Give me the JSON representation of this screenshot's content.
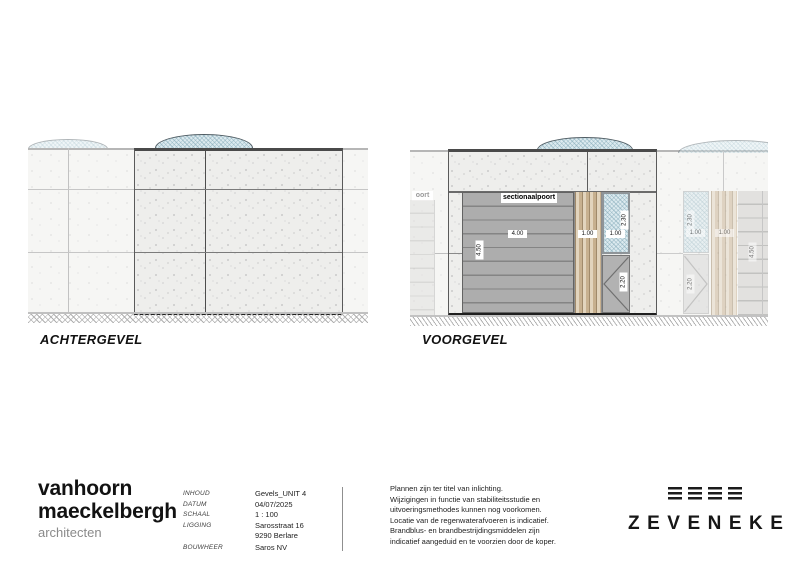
{
  "colors": {
    "window_blue": "#dceaef",
    "wood_tan": "#d4c1a4",
    "gate_gray": "#a5a5a5",
    "ink": "#121212"
  },
  "icons": {
    "door_swing": "chevron-lines",
    "logo_mark": "four-triple-bars"
  },
  "drawings": {
    "achtergevel": {
      "title": "ACHTERGEVEL"
    },
    "voorgevel": {
      "title": "VOORGEVEL",
      "gate_label": "sectionaalpoort",
      "gate_label_partial": "oort",
      "dims": {
        "gate_width": "4.00",
        "gate_height": "4.50",
        "slats_width": "1.00",
        "window_width": "1.00",
        "window_height": "2.30",
        "door_height": "2.20"
      },
      "adjacent_dims": {
        "window_height": "2.30",
        "window_width": "1.00",
        "slats_width": "1.00",
        "door_height": "2.20",
        "gate_height": "4.50"
      }
    }
  },
  "titleblock": {
    "firm": {
      "line1": "vanhoorn",
      "line2": "maeckelbergh",
      "subtitle": "architecten"
    },
    "fields": [
      {
        "label": "INHOUD",
        "value": "Gevels_UNIT 4"
      },
      {
        "label": "DATUM",
        "value": "04/07/2025"
      },
      {
        "label": "SCHAAL",
        "value": "1 : 100"
      },
      {
        "label": "LIGGING",
        "value": "Sarosstraat 16"
      },
      {
        "label": "",
        "value": "9290 Berlare"
      },
      {
        "label": "BOUWHEER",
        "value": "Saros NV"
      }
    ],
    "disclaimer": [
      "Plannen zijn ter titel van inlichting.",
      "Wijzigingen in functie van stabiliteitsstudie en",
      "uitvoeringsmethodes kunnen nog voorkomen.",
      "Locatie van de regenwaterafvoeren is indicatief.",
      "Brandblus- en brandbestrijdingsmiddelen zijn",
      "indicatief aangeduid en te voorzien door de koper."
    ],
    "brand": "ZEVENEKE"
  }
}
